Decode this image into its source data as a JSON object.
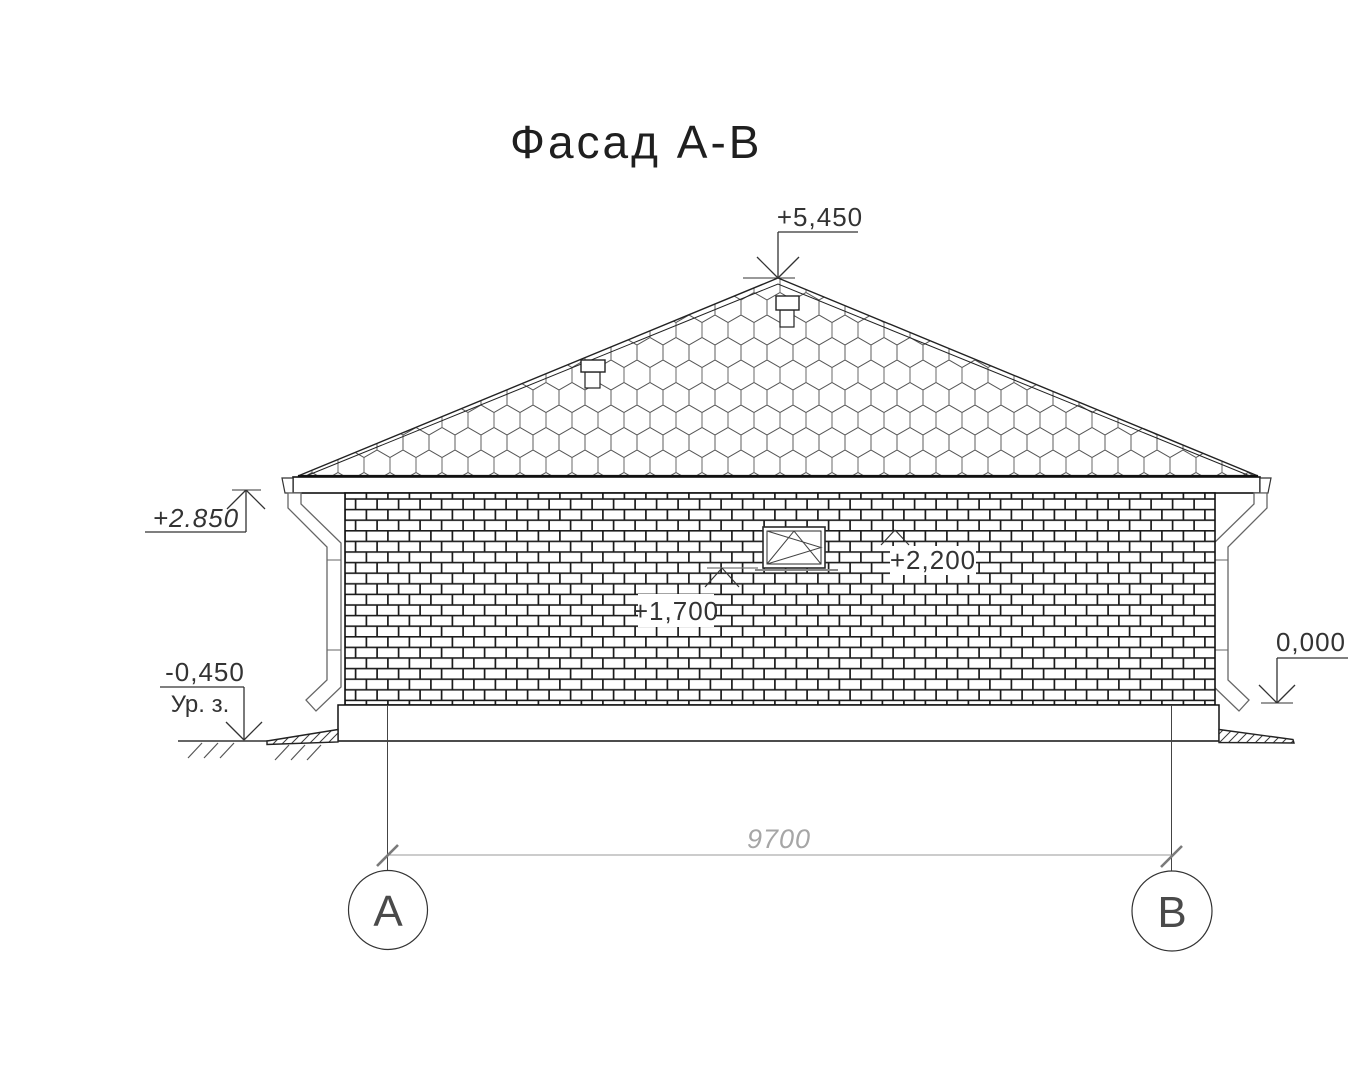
{
  "title": "Фасад А-В",
  "levels": {
    "peak": "+5,450",
    "eaves": "+2.850",
    "window_head": "+2,200",
    "window_sill": "+1,700",
    "floor": "0,000",
    "ground": "-0,450",
    "ground_label": "Ур. з."
  },
  "dimensions": {
    "span": "9700"
  },
  "axes": {
    "left": "А",
    "right": "В"
  },
  "colors": {
    "ink": "#1a1a1a",
    "dim_gray": "#9a9a9a"
  }
}
